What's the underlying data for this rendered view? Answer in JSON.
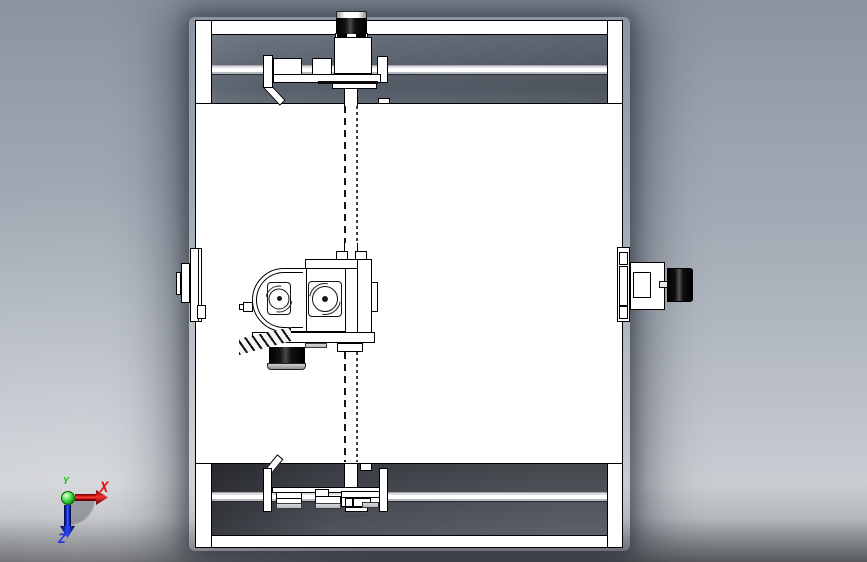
{
  "viewport": {
    "description_label": "",
    "triad": {
      "x_axis": {
        "label": "X",
        "color": "#e11414"
      },
      "y_axis": {
        "label": "Y",
        "color": "#1cc41c"
      },
      "z_axis": {
        "label": "Z",
        "color": "#2635de"
      }
    }
  },
  "palette": {
    "part-fill": "#ffffff",
    "edge": "#000000",
    "bg-top": "#8a93a0",
    "bg-light": "#c9ccd1",
    "bg-bottom": "#57595d",
    "cavity-top": "#5d6571",
    "cavity-bottom": "#43464d",
    "motor-black": "#0a0a0a",
    "axis-x": "#e11414",
    "axis-y": "#1cc41c",
    "axis-z": "#2635de"
  }
}
